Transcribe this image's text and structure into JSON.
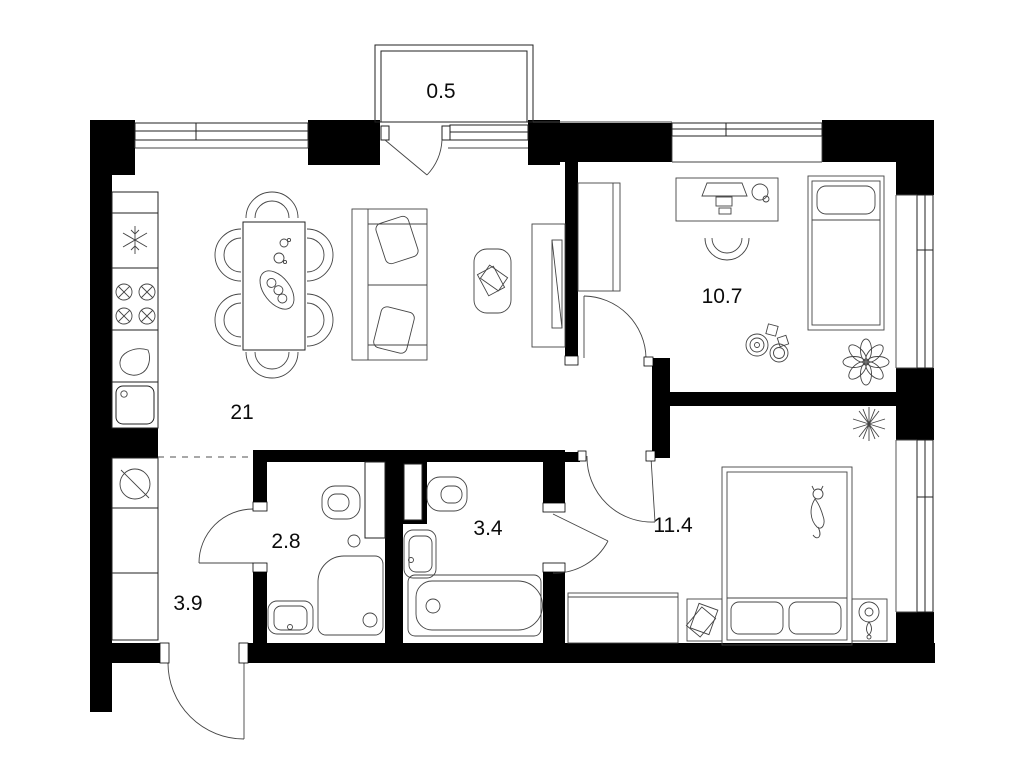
{
  "title": "apartment-floor-plan",
  "colors": {
    "wall": "#000000",
    "background": "#ffffff",
    "line": "#222222",
    "dashed_zone_line": "#8c8c8c",
    "label_text": "#0b0b0b"
  },
  "rooms": [
    {
      "id": "balcony",
      "area": "0.5"
    },
    {
      "id": "kitchen-living-room",
      "area": "21"
    },
    {
      "id": "child-bedroom",
      "area": "10.7"
    },
    {
      "id": "toilet-room",
      "area": "2.8"
    },
    {
      "id": "bathroom",
      "area": "3.4"
    },
    {
      "id": "bedroom",
      "area": "11.4"
    },
    {
      "id": "hallway",
      "area": "3.9"
    }
  ],
  "icons": [
    "fridge-icon",
    "stove-icon",
    "kitchen-sink-icon",
    "drop-icon",
    "washing-machine-icon",
    "dining-table-icon",
    "chair-icon",
    "sofa-icon",
    "coffee-table-icon",
    "tv-icon",
    "desk-icon",
    "monitor-icon",
    "office-chair-icon",
    "wardrobe-icon",
    "single-bed-icon",
    "double-bed-icon",
    "nightstand-icon",
    "lamp-icon",
    "plant-icon",
    "cat-icon",
    "toilet-icon",
    "shower-icon",
    "bathtub-icon",
    "washbasin-icon",
    "toys-icon",
    "door-swing-icon",
    "window-icon"
  ]
}
